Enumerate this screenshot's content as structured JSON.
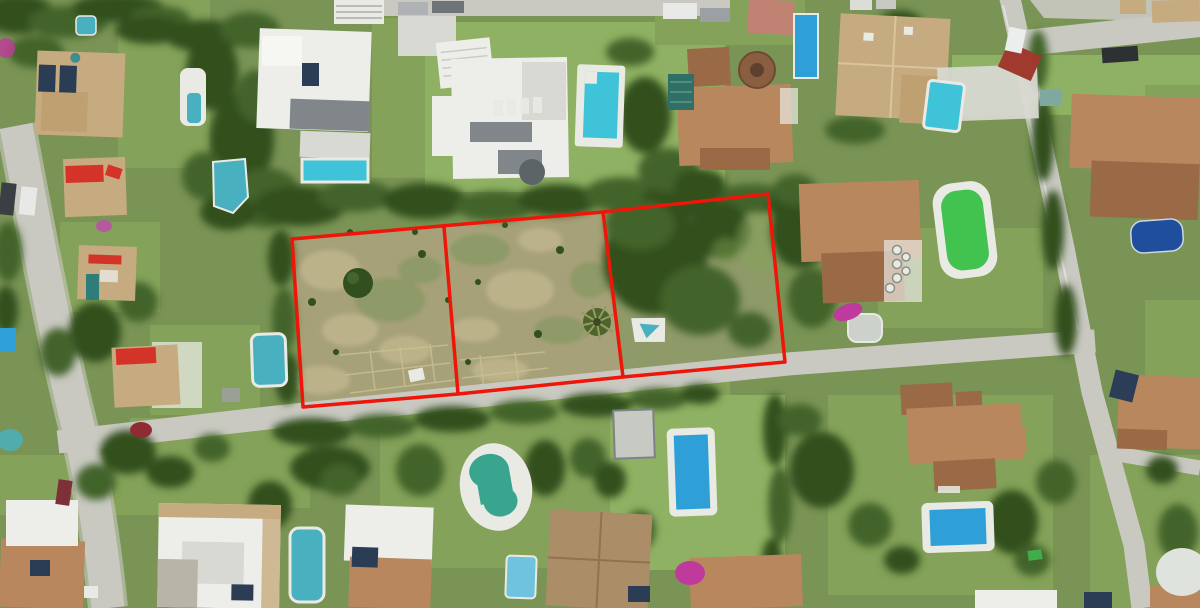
{
  "scene_label": "Aerial satellite view of a residential villa neighbourhood with swimming pools; a vacant land plot is outlined in red and divided into three sections",
  "annotation": {
    "outline_color": "#ee1509",
    "outline_width": "3.5",
    "plot_outline_points": "292,239 603,212 768,194 785,362 623,377 458,394 303,407",
    "divider_1_points": "444,227 458,394",
    "divider_2_points": "603,212 623,377",
    "sections": 3
  },
  "palette": {
    "base-green": "#7a9455",
    "lawn-green": "#84a259",
    "lawn-bright": "#8fb163",
    "scrub-tan": "#a7a179",
    "scrub-light": "#bcb28a",
    "scrub-green": "#8e9a68",
    "tree-dark": "#32501f",
    "tree-mid": "#43642c",
    "tree-light": "#6d8c43",
    "road-gray": "#c9c9c2",
    "road-light": "#d9d9d3",
    "roof-terracotta": "#b9875d",
    "roof-terracotta-dark": "#9a6a47",
    "roof-tan": "#c7ab80",
    "roof-red": "#a03a2e",
    "awning-red": "#d43428",
    "building-white": "#edeeea",
    "building-gray": "#81868a",
    "deck-white": "#e9eae4",
    "water-cyan": "#3fc3d8",
    "water-blue": "#2f9fd8",
    "water-teal": "#49b0bf",
    "water-green": "#42c24f",
    "water-dark": "#1f4f9c",
    "solar-dark": "#2b3c55",
    "magenta": "#c0399c"
  }
}
